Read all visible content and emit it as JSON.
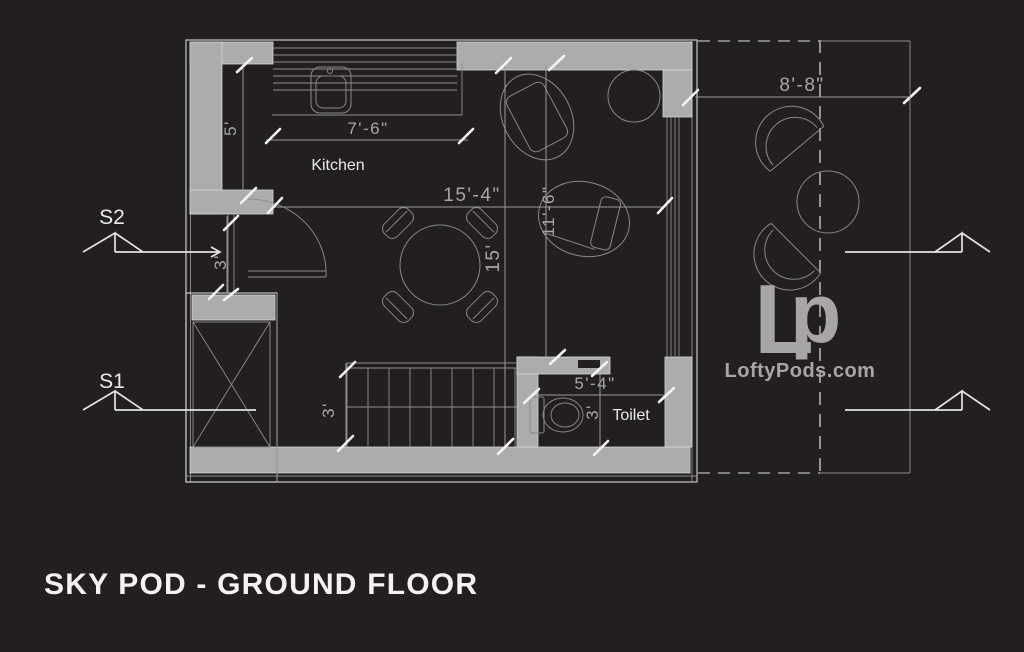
{
  "title": "SKY POD - GROUND FLOOR",
  "labels": {
    "kitchen": "Kitchen",
    "toilet": "Toilet",
    "s1": "S1",
    "s2": "S2"
  },
  "dimensions": {
    "kitchen_width": "7'-6\"",
    "kitchen_depth": "5'",
    "living_width": "15'-4\"",
    "living_depth": "15'",
    "sitting_depth": "11'-6\"",
    "entry_opening": "3'",
    "stair_width": "3'",
    "toilet_width": "5'-4\"",
    "toilet_depth": "3'",
    "terrace_width": "8'-8\""
  },
  "logo": {
    "mark_l": "L",
    "mark_p": "p",
    "site": "LoftyPods.com"
  },
  "colors": {
    "background": "#231F20",
    "wall": "#ACACAC",
    "bright_tick": "#F3F3F3",
    "label_text": "#EAEAEA",
    "dim_text": "#A6A6A6",
    "logo_gray": "#A7A5A6"
  }
}
